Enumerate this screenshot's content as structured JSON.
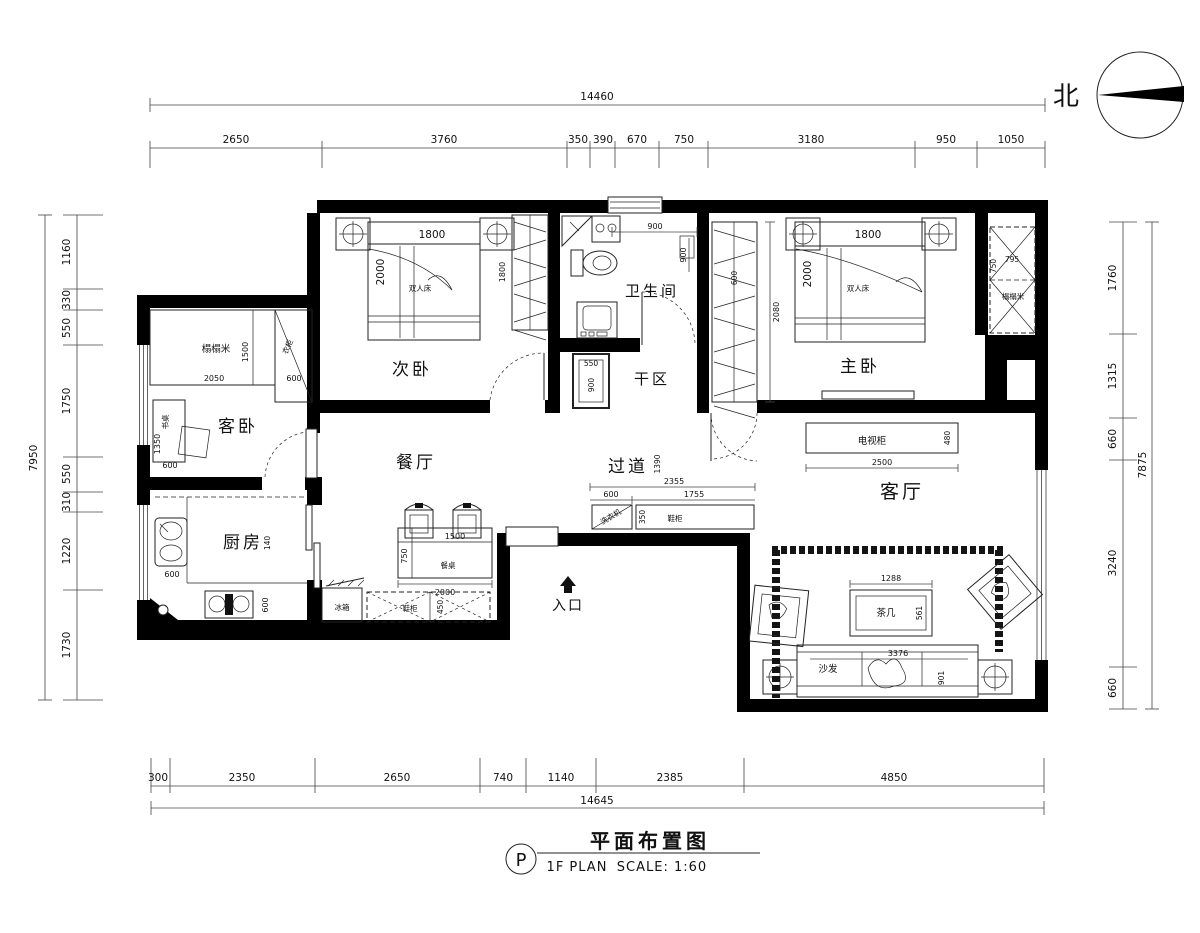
{
  "north_label": "北",
  "title_block": {
    "bubble": "P",
    "plan_code": "1F PLAN",
    "title": "平面布置图",
    "scale": "SCALE: 1:60"
  },
  "dims": {
    "top": {
      "total": "14460",
      "segments": [
        "2650",
        "3760",
        "350",
        "390",
        "670",
        "750",
        "3180",
        "950",
        "1050"
      ]
    },
    "bottom": {
      "total": "14645",
      "segments": [
        "300",
        "2350",
        "2650",
        "740",
        "1140",
        "2385",
        "4850"
      ]
    },
    "left": {
      "total": "7950",
      "segments": [
        "1160",
        "330",
        "550",
        "1750",
        "550",
        "310",
        "1220",
        "1730"
      ]
    },
    "right": {
      "total": "7875",
      "segments": [
        "1760",
        "1315",
        "660",
        "3240",
        "660"
      ]
    }
  },
  "rooms": {
    "secondary_bedroom": {
      "label": "次卧",
      "bed_width": "1800",
      "bed_depth": "2000",
      "bed_type": "双人床",
      "wardrobe_height": "1800"
    },
    "master_bedroom": {
      "label": "主卧",
      "bed_width": "1800",
      "bed_depth": "2000",
      "bed_type": "双人床",
      "closet_height": "2080",
      "closet_depth": "600"
    },
    "bathroom": {
      "label": "卫生间",
      "shower_width": "900",
      "shower_depth": "900"
    },
    "dry_area": {
      "label": "干区",
      "vanity_width": "550",
      "vanity_depth": "900"
    },
    "tatami_closet": {
      "label": "榻榻米",
      "width": "795",
      "depth": "750"
    },
    "guest_bedroom": {
      "label": "客卧",
      "tatami": "榻榻米",
      "tatami_width": "2050",
      "tatami_depth": "1500",
      "wardrobe": "衣柜",
      "wardrobe_width": "600",
      "desk": "书桌",
      "desk_length": "1350",
      "desk_width": "600"
    },
    "kitchen": {
      "label": "厨房",
      "counter_note": "140",
      "sink_depth": "600",
      "stove_depth": "600"
    },
    "dining": {
      "label": "餐厅",
      "table": "餐桌",
      "table_width": "1500",
      "table_depth": "750",
      "span": "2000",
      "fridge": "冰箱",
      "shoe_cabinet": "鞋柜",
      "shoe_cabinet_depth": "450"
    },
    "corridor": {
      "label": "过道",
      "width": "1390",
      "run": "2355",
      "seg_a": "600",
      "seg_b": "1755",
      "cabinet_a": "洗衣机",
      "cabinet_b": "鞋柜",
      "cabinet_depth": "350"
    },
    "living": {
      "label": "客厅",
      "tv_cabinet": "电视柜",
      "tv_width": "2500",
      "tv_depth": "480",
      "coffee_table": "茶几",
      "coffee_width": "1288",
      "coffee_depth": "561",
      "sofa": "沙发",
      "sofa_width": "3376",
      "sofa_depth": "901"
    },
    "entry": {
      "label": "入口"
    }
  }
}
